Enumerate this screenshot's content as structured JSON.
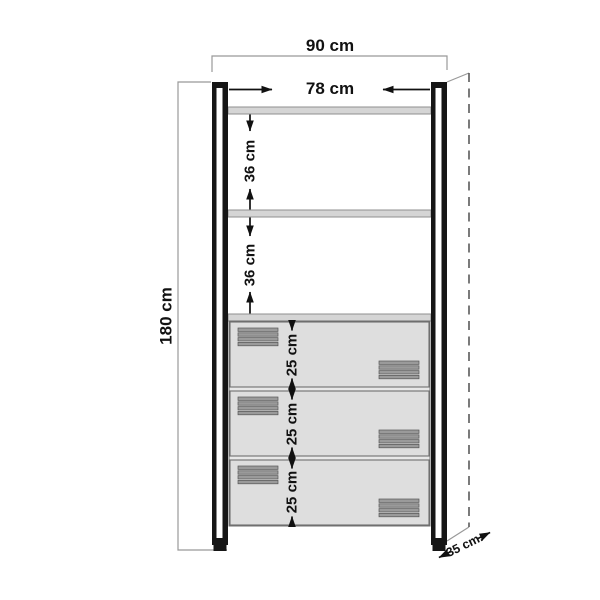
{
  "diagram": {
    "labels": {
      "total_width": "90 cm",
      "inner_width": "78 cm",
      "total_height": "180 cm",
      "upper_shelf_gap": "36 cm",
      "lower_shelf_gap": "36 cm",
      "drawer1_height": "25 cm",
      "drawer2_height": "25 cm",
      "drawer3_height": "25 cm",
      "depth": "35 cm."
    }
  },
  "colors": {
    "background": "#ffffff",
    "frame": "#161616",
    "shelf-fill": "#d5d5d5",
    "shelf-edge": "#8f8f8f",
    "drawer-fill": "#dedede",
    "drawer-edge": "#6f6f6f",
    "backing": "#e8e8e8",
    "vent": "#9a9a9a",
    "vent-edge": "#555555",
    "outline": "#999999",
    "dash": "#5a5a5a",
    "dim": "#111111"
  }
}
